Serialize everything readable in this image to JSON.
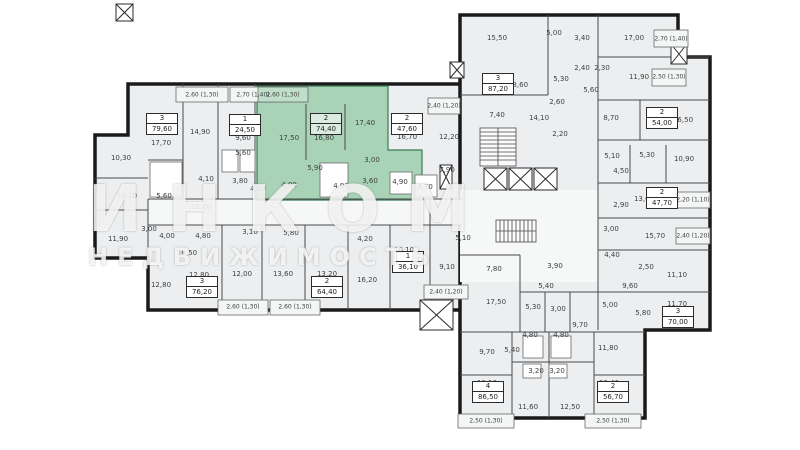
{
  "watermark": {
    "line1": "ИНКОМ",
    "line2": "НЕДВИЖИМОСТЬ"
  },
  "colors": {
    "highlight": "#a9d3b6",
    "walls": "#1a1a1a",
    "room_fill": "#eceef0"
  },
  "apartments": [
    {
      "rooms": "3",
      "area": "79,60",
      "x": 162,
      "y": 124,
      "highlighted": false
    },
    {
      "rooms": "1",
      "area": "24,50",
      "x": 245,
      "y": 125,
      "highlighted": false
    },
    {
      "rooms": "2",
      "area": "74,40",
      "x": 326,
      "y": 124,
      "highlighted": true
    },
    {
      "rooms": "2",
      "area": "47,60",
      "x": 407,
      "y": 124,
      "highlighted": false
    },
    {
      "rooms": "3",
      "area": "87,20",
      "x": 498,
      "y": 84,
      "highlighted": false
    },
    {
      "rooms": "2",
      "area": "54,00",
      "x": 662,
      "y": 118,
      "highlighted": false
    },
    {
      "rooms": "2",
      "area": "47,70",
      "x": 662,
      "y": 198,
      "highlighted": false
    },
    {
      "rooms": "1",
      "area": "36,10",
      "x": 408,
      "y": 262,
      "highlighted": false
    },
    {
      "rooms": "3",
      "area": "76,20",
      "x": 202,
      "y": 287,
      "highlighted": false
    },
    {
      "rooms": "2",
      "area": "64,40",
      "x": 327,
      "y": 287,
      "highlighted": false
    },
    {
      "rooms": "4",
      "area": "86,50",
      "x": 488,
      "y": 392,
      "highlighted": false
    },
    {
      "rooms": "2",
      "area": "56,70",
      "x": 613,
      "y": 392,
      "highlighted": false
    },
    {
      "rooms": "3",
      "area": "70,00",
      "x": 678,
      "y": 317,
      "highlighted": false
    }
  ],
  "room_labels": [
    {
      "t": "17,70",
      "x": 161,
      "y": 143
    },
    {
      "t": "14,90",
      "x": 200,
      "y": 132
    },
    {
      "t": "10,30",
      "x": 121,
      "y": 158
    },
    {
      "t": "13,10",
      "x": 127,
      "y": 196
    },
    {
      "t": "5,60",
      "x": 164,
      "y": 196
    },
    {
      "t": "9,60",
      "x": 243,
      "y": 138
    },
    {
      "t": "5,60",
      "x": 243,
      "y": 153
    },
    {
      "t": "3,80",
      "x": 240,
      "y": 181
    },
    {
      "t": "4,10",
      "x": 258,
      "y": 189
    },
    {
      "t": "4,10",
      "x": 206,
      "y": 179
    },
    {
      "t": "12,60",
      "x": 201,
      "y": 207
    },
    {
      "t": "11,90",
      "x": 118,
      "y": 239
    },
    {
      "t": "3,00",
      "x": 149,
      "y": 229
    },
    {
      "t": "4,00",
      "x": 167,
      "y": 236
    },
    {
      "t": "4,80",
      "x": 203,
      "y": 236
    },
    {
      "t": "10,50",
      "x": 187,
      "y": 253
    },
    {
      "t": "12,80",
      "x": 161,
      "y": 285
    },
    {
      "t": "3,10",
      "x": 250,
      "y": 232
    },
    {
      "t": "5,80",
      "x": 291,
      "y": 233
    },
    {
      "t": "12,80",
      "x": 199,
      "y": 275
    },
    {
      "t": "12,00",
      "x": 242,
      "y": 274
    },
    {
      "t": "13,60",
      "x": 283,
      "y": 274
    },
    {
      "t": "13,20",
      "x": 327,
      "y": 274
    },
    {
      "t": "16,20",
      "x": 367,
      "y": 280
    },
    {
      "t": "4,20",
      "x": 365,
      "y": 239
    },
    {
      "t": "16,10",
      "x": 404,
      "y": 250
    },
    {
      "t": "9,10",
      "x": 447,
      "y": 267
    },
    {
      "t": "5,10",
      "x": 463,
      "y": 238
    },
    {
      "t": "17,50",
      "x": 289,
      "y": 138
    },
    {
      "t": "16,80",
      "x": 324,
      "y": 138
    },
    {
      "t": "17,40",
      "x": 365,
      "y": 123
    },
    {
      "t": "5,90",
      "x": 315,
      "y": 168
    },
    {
      "t": "4,00",
      "x": 289,
      "y": 185
    },
    {
      "t": "4,90",
      "x": 341,
      "y": 186
    },
    {
      "t": "3,60",
      "x": 370,
      "y": 181
    },
    {
      "t": "3,00",
      "x": 372,
      "y": 160
    },
    {
      "t": "16,70",
      "x": 407,
      "y": 137
    },
    {
      "t": "4,90",
      "x": 400,
      "y": 182
    },
    {
      "t": "4,70",
      "x": 425,
      "y": 187
    },
    {
      "t": "12,20",
      "x": 449,
      "y": 137
    },
    {
      "t": "7,90",
      "x": 447,
      "y": 170
    },
    {
      "t": "15,50",
      "x": 497,
      "y": 38
    },
    {
      "t": "5,00",
      "x": 554,
      "y": 33
    },
    {
      "t": "3,40",
      "x": 582,
      "y": 38
    },
    {
      "t": "18,60",
      "x": 518,
      "y": 85
    },
    {
      "t": "2,40",
      "x": 582,
      "y": 68
    },
    {
      "t": "2,30",
      "x": 602,
      "y": 68
    },
    {
      "t": "5,30",
      "x": 561,
      "y": 79
    },
    {
      "t": "5,60",
      "x": 591,
      "y": 90
    },
    {
      "t": "2,60",
      "x": 557,
      "y": 102
    },
    {
      "t": "7,40",
      "x": 497,
      "y": 115
    },
    {
      "t": "14,10",
      "x": 539,
      "y": 118
    },
    {
      "t": "2,20",
      "x": 560,
      "y": 134
    },
    {
      "t": "17,00",
      "x": 634,
      "y": 38
    },
    {
      "t": "11,90",
      "x": 639,
      "y": 77
    },
    {
      "t": "8,70",
      "x": 611,
      "y": 118
    },
    {
      "t": "16,50",
      "x": 683,
      "y": 120
    },
    {
      "t": "5,10",
      "x": 612,
      "y": 156
    },
    {
      "t": "5,30",
      "x": 647,
      "y": 155
    },
    {
      "t": "10,90",
      "x": 684,
      "y": 159
    },
    {
      "t": "4,50",
      "x": 621,
      "y": 171
    },
    {
      "t": "13,60",
      "x": 644,
      "y": 199
    },
    {
      "t": "2,90",
      "x": 621,
      "y": 205
    },
    {
      "t": "3,00",
      "x": 611,
      "y": 229
    },
    {
      "t": "15,70",
      "x": 655,
      "y": 236
    },
    {
      "t": "4,40",
      "x": 612,
      "y": 255
    },
    {
      "t": "2,50",
      "x": 646,
      "y": 267
    },
    {
      "t": "11,10",
      "x": 677,
      "y": 275
    },
    {
      "t": "9,60",
      "x": 630,
      "y": 286
    },
    {
      "t": "3,90",
      "x": 555,
      "y": 266
    },
    {
      "t": "7,80",
      "x": 494,
      "y": 269
    },
    {
      "t": "17,50",
      "x": 496,
      "y": 302
    },
    {
      "t": "5,30",
      "x": 533,
      "y": 307
    },
    {
      "t": "3,00",
      "x": 558,
      "y": 309
    },
    {
      "t": "5,40",
      "x": 546,
      "y": 286
    },
    {
      "t": "9,70",
      "x": 580,
      "y": 325
    },
    {
      "t": "5,00",
      "x": 610,
      "y": 305
    },
    {
      "t": "5,80",
      "x": 643,
      "y": 313
    },
    {
      "t": "11,70",
      "x": 677,
      "y": 304
    },
    {
      "t": "11,80",
      "x": 608,
      "y": 348
    },
    {
      "t": "9,70",
      "x": 487,
      "y": 352
    },
    {
      "t": "5,40",
      "x": 512,
      "y": 350
    },
    {
      "t": "4,80",
      "x": 530,
      "y": 335
    },
    {
      "t": "4,80",
      "x": 561,
      "y": 335
    },
    {
      "t": "3,20",
      "x": 536,
      "y": 371
    },
    {
      "t": "3,20",
      "x": 557,
      "y": 371
    },
    {
      "t": "10,10",
      "x": 487,
      "y": 383
    },
    {
      "t": "11,60",
      "x": 528,
      "y": 407
    },
    {
      "t": "12,50",
      "x": 570,
      "y": 407
    },
    {
      "t": "10,40",
      "x": 609,
      "y": 383
    }
  ],
  "balcony_labels": [
    {
      "t": "2,60 (1,30)",
      "x": 202,
      "y": 95
    },
    {
      "t": "2,70 (1,40)",
      "x": 253,
      "y": 95
    },
    {
      "t": "2,60 (1,30)",
      "x": 283,
      "y": 95
    },
    {
      "t": "2,60 (1,30)",
      "x": 243,
      "y": 307
    },
    {
      "t": "2,60 (1,30)",
      "x": 295,
      "y": 307
    },
    {
      "t": "2,40 (1,20)",
      "x": 446,
      "y": 292
    },
    {
      "t": "2,40 (1,20)",
      "x": 444,
      "y": 106
    },
    {
      "t": "2,50 (1,30)",
      "x": 486,
      "y": 421
    },
    {
      "t": "2,50 (1,30)",
      "x": 613,
      "y": 421
    },
    {
      "t": "2,70 (1,40)",
      "x": 671,
      "y": 39
    },
    {
      "t": "2,50 (1,30)",
      "x": 669,
      "y": 77
    },
    {
      "t": "2,20 (1,10)",
      "x": 693,
      "y": 200
    },
    {
      "t": "2,40 (1,20)",
      "x": 693,
      "y": 236
    }
  ]
}
